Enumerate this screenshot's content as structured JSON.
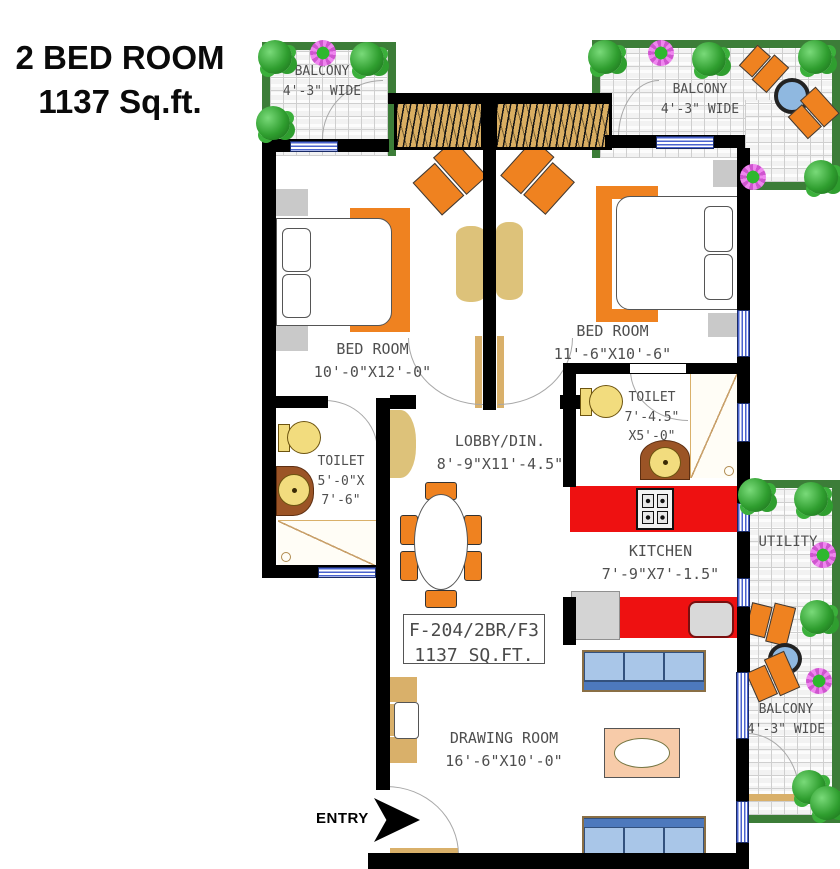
{
  "title": {
    "line1": "2 BED ROOM",
    "line2": "1137 Sq.ft."
  },
  "entry_label": "ENTRY",
  "unit_box": {
    "line1": "F-204/2BR/F3",
    "line2": "1137 SQ.FT."
  },
  "rooms": {
    "balcony_top_left": {
      "name": "BALCONY",
      "dim": "4'-3\" WIDE"
    },
    "balcony_top_right": {
      "name": "BALCONY",
      "dim": "4'-3\" WIDE"
    },
    "balcony_bottom_right": {
      "name": "BALCONY",
      "dim": "4'-3\" WIDE"
    },
    "utility": {
      "name": "UTILITY"
    },
    "bedroom_left": {
      "name": "BED ROOM",
      "dim": "10'-0\"X12'-0\""
    },
    "bedroom_right": {
      "name": "BED ROOM",
      "dim": "11'-6\"X10'-6\""
    },
    "toilet_left": {
      "name": "TOILET",
      "dim1": "5'-0\"X",
      "dim2": "7'-6\""
    },
    "toilet_right": {
      "name": "TOILET",
      "dim1": "7'-4.5\"",
      "dim2": "X5'-0\""
    },
    "lobby": {
      "name": "LOBBY/DIN.",
      "dim": "8'-9\"X11'-4.5\""
    },
    "kitchen": {
      "name": "KITCHEN",
      "dim": "7'-9\"X7'-1.5\""
    },
    "drawing_room": {
      "name": "DRAWING ROOM",
      "dim": "16'-6\"X10'-0\""
    }
  },
  "colors": {
    "wall": "#000000",
    "furniture_orange": "#ef8220",
    "kitchen_counter_red": "#ee1111",
    "balcony_border_green": "#3c7d38",
    "sofa_blue": "#4d79bd",
    "wood_tan": "#d9ae62",
    "fixture_yellow": "#f2dc7e",
    "counter_brown": "#9b5426",
    "window_blue": "#4a63cf"
  }
}
